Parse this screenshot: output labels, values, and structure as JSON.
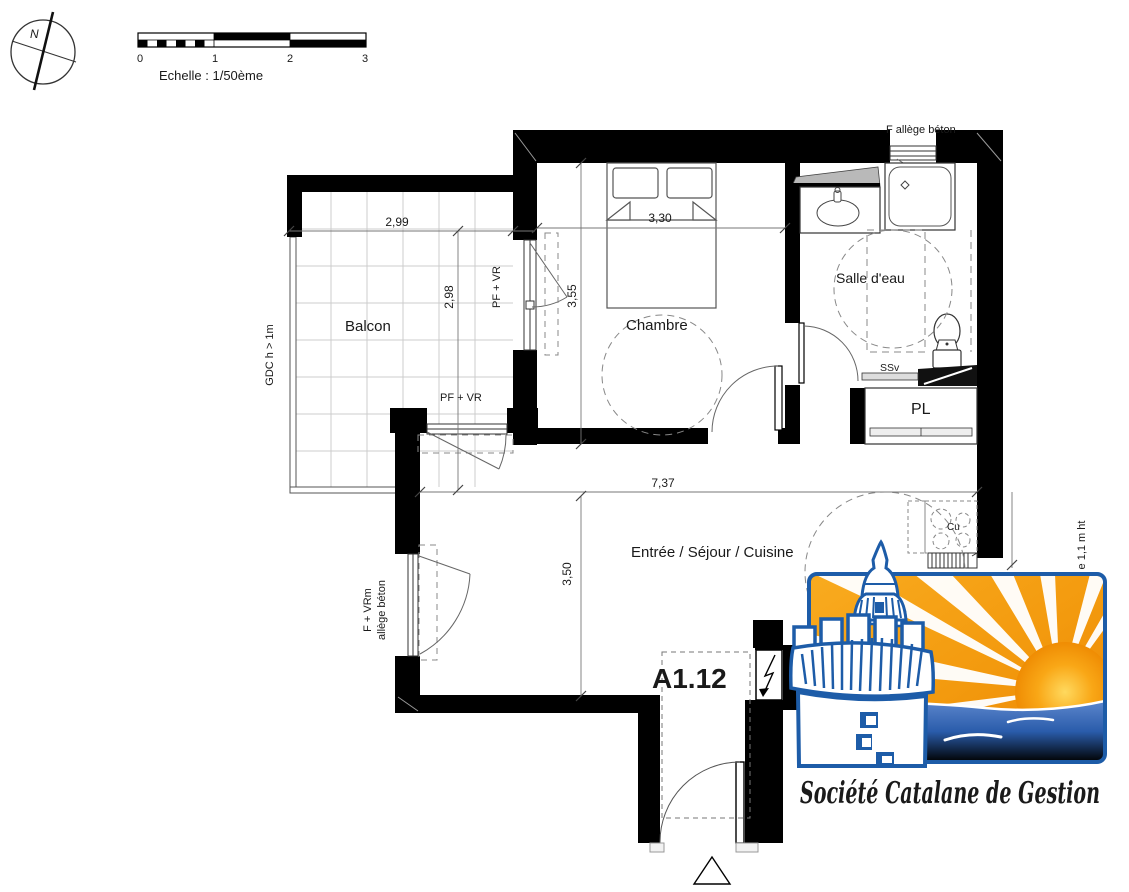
{
  "compass": {
    "label": "N"
  },
  "scale_bar": {
    "caption": "Echelle : 1/50ème",
    "ticks": [
      "0",
      "1",
      "2",
      "3"
    ]
  },
  "unit": {
    "number": "A1.12"
  },
  "rooms": {
    "balcony": "Balcon",
    "bedroom": "Chambre",
    "bathroom": "Salle d'eau",
    "closet": "PL",
    "living": "Entrée / Séjour / Cuisine"
  },
  "dimensions": {
    "balcony_width": "2,99",
    "balcony_depth": "2,98",
    "bedroom_width": "3,30",
    "bedroom_depth": "3,55",
    "living_width": "7,37",
    "living_depth": "3,50"
  },
  "annotations": {
    "guardrail": "GDC h > 1m",
    "window_pf_vr": "PF + VR",
    "window_f_vrm_line1": "F + VRm",
    "window_f_vrm_line2": "allège béton",
    "bath_window": "F allège béton",
    "towel_dryer": "SSv",
    "cooktop": "Cu",
    "kitchen_sill_height": "e 1,1 m ht"
  },
  "logo": {
    "company": "Société Catalane de Gestion"
  },
  "colors": {
    "wall": "#000000",
    "logo_blue": "#1d5ca8",
    "logo_orange": "#f39a0e",
    "sea_blue": "#2a5cab"
  }
}
